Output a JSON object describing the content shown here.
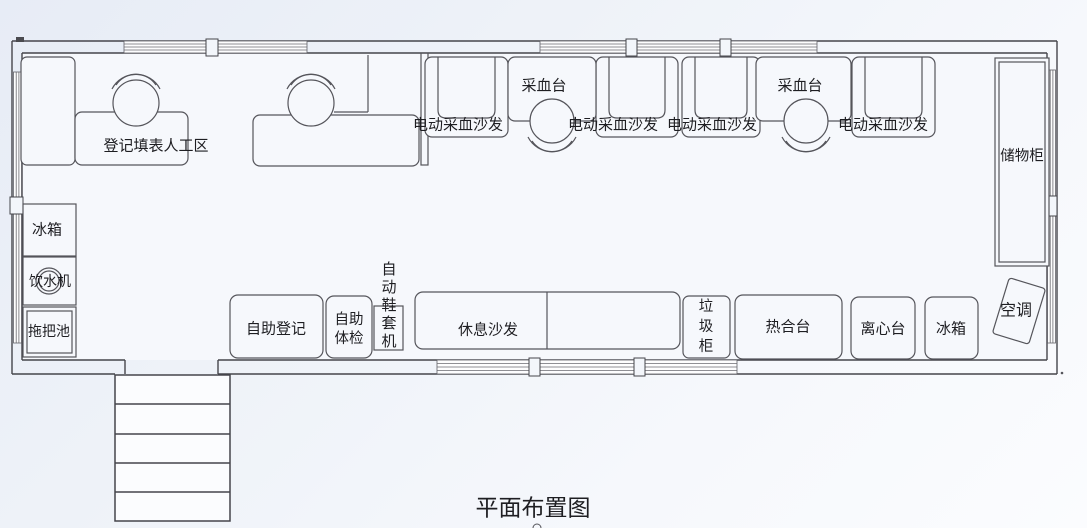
{
  "title": "平面布置图",
  "areas": {
    "registration": {
      "label": "登记填表人工区"
    },
    "collection": {
      "tables": [
        {
          "label": "采血台"
        },
        {
          "label": "采血台"
        }
      ],
      "sofas": [
        {
          "label": "电动采血沙发"
        },
        {
          "label": "电动采血沙发"
        },
        {
          "label": "电动采血沙发"
        },
        {
          "label": "电动采血沙发"
        }
      ]
    },
    "storage_cabinet": {
      "label": "储物柜"
    },
    "left_column": {
      "fridge": "冰箱",
      "water_dispenser": "饮水机",
      "mop_sink": "拖把池"
    },
    "bottom_row": {
      "self_registration": "自助登记",
      "self_checkup": "自助\n体检",
      "shoe_cover_machine": "自\n动\n鞋\n套\n机",
      "rest_sofa": "休息沙发",
      "trash_cabinet": "垃\n圾\n柜",
      "heat_sealer": "热合台",
      "centrifuge": "离心台",
      "fridge": "冰箱",
      "air_conditioner": "空调"
    }
  }
}
